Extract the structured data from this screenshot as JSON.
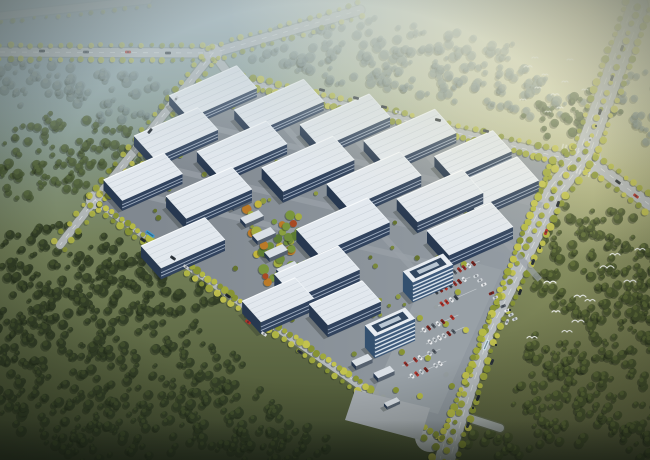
{
  "meta": {
    "kind": "aerial-architectural-rendering",
    "subject": "industrial-park",
    "width": 650,
    "height": 460
  },
  "palette": {
    "bgStops": [
      "#8fa5ad",
      "#94a795",
      "#7d8a63",
      "#6b7750",
      "#535d3b",
      "#3e472f"
    ],
    "warmGlow": "246,238,196",
    "coolGlow": "125,150,170",
    "hazeTop": "188,202,206",
    "rightWarmTint": "212,202,130",
    "vignette": "16,22,14",
    "asphalt": "#b3b8bb",
    "asphaltWide": "#b7bcbf",
    "casing": "#6e756f",
    "laneDash": "#eef2f2",
    "roadTree": [
      "#9fa83c",
      "#b4b944",
      "#879334",
      "#c2c24e"
    ],
    "treeStyles": [
      {
        "base": "#76898a",
        "hi": "#87998f",
        "op": 0.55
      },
      {
        "base": "#4c5c38",
        "hi": "#5d6f42",
        "op": 0.8
      },
      {
        "base": "#333f27",
        "hi": "#46542f",
        "op": 0.92
      },
      {
        "base": "#4a5730",
        "hi": "#66743c",
        "op": 0.9
      }
    ],
    "treeShadow": "#1f2819",
    "plot": [
      "#7e868e",
      "#959da4"
    ],
    "street": "#9aa1a8",
    "roofFactory": "#e2e8ee",
    "roofRidge": "#c9d1d9",
    "roofHi": "#f7fafc",
    "wallLong": "#31435e",
    "wallEnd": "#273850",
    "wallBand": "#b9c6d6",
    "towerWall": "#3e5a7b",
    "towerBand": "#dfe8ef",
    "towerRoof": "#e8edf2",
    "towerInset": "#31465f",
    "towerCore": "#b9c6d2",
    "shedRoof": "#d9dfe5",
    "shedWall": "#55606e",
    "shadow": "#1c2420",
    "parkPad": "#99a0a7",
    "plaza": "#a6acb1",
    "infillTree": [
      "#79883a",
      "#8d9a40",
      "#65742f"
    ],
    "gardenTree": [
      "#5d7c33",
      "#79953d",
      "#a3ad41",
      "#c3b63c",
      "#bb7a28",
      "#a84a24",
      "#6f8c3a",
      "#8aa03e"
    ],
    "parkCar": [
      "#b5342a",
      "#e8eaec",
      "#7c241e",
      "#cdd2d6",
      "#3a4148",
      "#e8eaec",
      "#99312a",
      "#596068"
    ],
    "bird": "#f4f6f4"
  },
  "forests": {
    "clusters": [
      [
        35,
        82,
        48,
        24,
        0
      ],
      [
        110,
        96,
        58,
        26,
        0
      ],
      [
        175,
        110,
        40,
        20,
        0
      ],
      [
        300,
        48,
        55,
        22,
        0
      ],
      [
        360,
        62,
        60,
        24,
        0
      ],
      [
        425,
        72,
        62,
        24,
        0
      ],
      [
        488,
        84,
        55,
        22,
        0
      ],
      [
        540,
        98,
        45,
        20,
        0
      ],
      [
        345,
        28,
        45,
        15,
        0
      ],
      [
        415,
        40,
        48,
        16,
        0
      ],
      [
        475,
        52,
        45,
        16,
        0
      ],
      [
        630,
        84,
        26,
        20,
        0
      ],
      [
        645,
        128,
        22,
        18,
        0
      ],
      [
        55,
        140,
        52,
        28,
        1
      ],
      [
        130,
        152,
        48,
        26,
        1
      ],
      [
        28,
        178,
        40,
        24,
        1
      ],
      [
        95,
        178,
        40,
        22,
        1
      ],
      [
        560,
        120,
        40,
        20,
        1
      ],
      [
        598,
        106,
        35,
        18,
        1
      ],
      [
        152,
        222,
        26,
        14,
        1
      ],
      [
        572,
        232,
        46,
        28,
        3
      ],
      [
        622,
        262,
        42,
        32,
        3
      ],
      [
        582,
        292,
        52,
        32,
        3
      ],
      [
        630,
        330,
        46,
        36,
        3
      ],
      [
        584,
        362,
        52,
        32,
        3
      ],
      [
        626,
        402,
        48,
        32,
        3
      ],
      [
        572,
        420,
        46,
        24,
        3
      ],
      [
        640,
        444,
        36,
        18,
        3
      ],
      [
        548,
        396,
        38,
        24,
        3
      ],
      [
        610,
        228,
        30,
        20,
        3
      ],
      [
        645,
        300,
        20,
        30,
        3
      ],
      [
        552,
        352,
        30,
        22,
        3
      ],
      [
        505,
        442,
        40,
        16,
        3
      ],
      [
        60,
        258,
        68,
        38,
        2
      ],
      [
        148,
        298,
        78,
        44,
        2
      ],
      [
        55,
        338,
        62,
        42,
        2
      ],
      [
        168,
        378,
        84,
        44,
        2
      ],
      [
        68,
        415,
        68,
        34,
        2
      ],
      [
        235,
        420,
        68,
        34,
        2
      ],
      [
        285,
        447,
        55,
        22,
        2
      ],
      [
        20,
        300,
        40,
        40,
        2
      ],
      [
        120,
        440,
        60,
        26,
        2
      ],
      [
        10,
        380,
        40,
        30,
        2
      ]
    ]
  },
  "roads": {
    "list": [
      {
        "id": "highway-top",
        "pts": [
          [
            0,
            16
          ],
          [
            148,
            0
          ]
        ],
        "w": 7,
        "op": 0.5,
        "trees": {
          "sides": [
            1
          ],
          "step": 11,
          "r": 2.0,
          "op": 0.55
        }
      },
      {
        "id": "road-topleft",
        "pts": [
          [
            0,
            52
          ],
          [
            213,
            53
          ],
          [
            360,
            10
          ]
        ],
        "w": 9,
        "op": 0.9,
        "dash": true,
        "trees": {
          "sides": [
            1,
            -1
          ],
          "step": 10,
          "r": 2.4,
          "op": 0.8
        }
      },
      {
        "id": "road-west",
        "pts": [
          [
            213,
            53
          ],
          [
            95,
            200
          ],
          [
            60,
            245
          ]
        ],
        "w": 8,
        "op": 0.95,
        "dash": true,
        "trees": {
          "sides": [
            1,
            -1
          ],
          "step": 10,
          "r": 2.6,
          "op": 0.85
        }
      },
      {
        "id": "road-connector",
        "pts": [
          [
            213,
            53
          ],
          [
            233,
            80
          ]
        ],
        "w": 8,
        "op": 0.95
      },
      {
        "id": "road-park-north",
        "pts": [
          [
            233,
            80
          ],
          [
            572,
            160
          ]
        ],
        "w": 9,
        "op": 1,
        "dash": true,
        "trees": {
          "sides": [
            1,
            -1
          ],
          "step": 9,
          "r": 2.8,
          "op": 0.95
        }
      },
      {
        "id": "road-park-west",
        "pts": [
          [
            95,
            200
          ],
          [
            428,
            432
          ]
        ],
        "w": 9,
        "op": 1,
        "dash": true,
        "trees": {
          "sides": [
            1,
            -1
          ],
          "step": 9,
          "r": 3.0,
          "op": 0.95
        }
      },
      {
        "id": "road-east-arm",
        "pts": [
          [
            592,
            162
          ],
          [
            650,
            205
          ]
        ],
        "w": 11,
        "op": 1,
        "dash": true,
        "trees": {
          "sides": [
            1,
            -1
          ],
          "step": 9,
          "r": 2.8,
          "op": 0.95
        }
      },
      {
        "id": "road-south-stub",
        "pts": [
          [
            428,
            405
          ],
          [
            500,
            428
          ]
        ],
        "w": 8,
        "op": 0.85
      },
      {
        "id": "boulevard-main",
        "pts": [
          [
            638,
            6
          ],
          [
            585,
            152
          ],
          [
            555,
            190
          ],
          [
            485,
            330
          ],
          [
            450,
            440
          ],
          [
            445,
            460
          ]
        ],
        "w": 20,
        "op": 1,
        "wide": true,
        "trees": {
          "sides": [
            1,
            -1
          ],
          "step": 8.5,
          "r": 3.0,
          "op": 0.95
        },
        "median": {
          "step": 9,
          "r": 2.6
        }
      }
    ],
    "pads": [
      [
        213,
        53,
        9
      ],
      [
        95,
        200,
        9
      ],
      [
        585,
        158,
        16
      ],
      [
        430,
        437,
        15
      ],
      [
        592,
        163,
        11
      ]
    ],
    "crosswalks": [
      [
        562,
        146,
        580,
        151
      ],
      [
        590,
        175,
        574,
        170
      ],
      [
        370,
        408,
        386,
        413
      ]
    ]
  },
  "vehicles": {
    "cars": [
      [
        42,
        51,
        1,
        "#2a3138"
      ],
      [
        86,
        52,
        1,
        "#3a424a"
      ],
      [
        128,
        52,
        1,
        "#b03028"
      ],
      [
        168,
        53,
        1,
        "#2a3138"
      ],
      [
        150,
        131,
        -51,
        "#2a3138"
      ],
      [
        176,
        99,
        -51,
        "#c8ccd0"
      ],
      [
        143,
        240,
        35,
        "#23292f"
      ],
      [
        173,
        258,
        35,
        "#2e353c"
      ],
      [
        186,
        267,
        35,
        "#c8ccd0"
      ],
      [
        228,
        296,
        35,
        "#23292f"
      ],
      [
        248,
        322,
        35,
        "#b03028"
      ],
      [
        264,
        334,
        35,
        "#d8dadc"
      ],
      [
        300,
        352,
        35,
        "#2e353c"
      ],
      [
        322,
        90,
        13,
        "#23292f"
      ],
      [
        356,
        98,
        13,
        "#2e353c"
      ],
      [
        384,
        107,
        13,
        "#23292f"
      ],
      [
        398,
        112,
        13,
        "#c8ccd0"
      ],
      [
        438,
        120,
        13,
        "#23292f"
      ],
      [
        486,
        131,
        13,
        "#2e353c"
      ],
      [
        622,
        48,
        110,
        "#23292f"
      ],
      [
        612,
        78,
        110,
        "#2e353c"
      ],
      [
        600,
        112,
        110,
        "#23292f"
      ],
      [
        590,
        140,
        110,
        "#c8ccd0"
      ],
      [
        558,
        204,
        110,
        "#23292f"
      ],
      [
        546,
        232,
        110,
        "#b03028"
      ],
      [
        533,
        262,
        110,
        "#2e353c"
      ],
      [
        520,
        292,
        110,
        "#23292f"
      ],
      [
        507,
        322,
        113,
        "#c8ccd0"
      ],
      [
        492,
        362,
        113,
        "#2e353c"
      ],
      [
        478,
        398,
        113,
        "#23292f"
      ],
      [
        468,
        425,
        113,
        "#2e353c"
      ],
      [
        618,
        182,
        37,
        "#23292f"
      ],
      [
        636,
        196,
        37,
        "#b03028"
      ]
    ],
    "buses": [
      [
        150,
        234,
        35,
        "#3f9ad0",
        10
      ],
      [
        486,
        345,
        113,
        "#cfe2ea",
        11
      ]
    ],
    "bikes": [
      [
        510,
        310
      ],
      [
        496,
        345
      ],
      [
        473,
        408
      ],
      [
        596,
        126
      ],
      [
        540,
        248
      ]
    ]
  },
  "park": {
    "plot": [
      [
        238,
        84
      ],
      [
        552,
        160
      ],
      [
        442,
        438
      ],
      [
        100,
        204
      ]
    ],
    "perimeter": {
      "step": 6.5,
      "rMin": 2.2,
      "rMax": 4.2
    },
    "streetsU": [
      [
        192,
        123,
        360
      ],
      [
        145,
        163,
        360
      ],
      [
        120,
        190,
        350
      ]
    ],
    "streetsV": [
      [
        252,
        90,
        268
      ],
      [
        324,
        104,
        240
      ],
      [
        396,
        120,
        215
      ]
    ],
    "infill": {
      "count": 80,
      "rMin": 1.6,
      "rMax": 3.0
    },
    "garden": {
      "poly": [
        [
          244,
          198
        ],
        [
          298,
          212
        ],
        [
          322,
          316
        ],
        [
          262,
          300
        ]
      ],
      "count": 60,
      "rMin": 2.4,
      "rMax": 5.4
    },
    "accents": [
      [
        512,
        185
      ],
      [
        517,
        191
      ],
      [
        509,
        193
      ],
      [
        362,
        308
      ],
      [
        300,
        240
      ]
    ],
    "factories": [
      [
        213,
        92,
        74,
        30,
        9
      ],
      [
        279,
        106,
        76,
        30,
        9
      ],
      [
        345,
        121,
        76,
        31,
        10
      ],
      [
        410,
        137,
        78,
        32,
        10
      ],
      [
        473,
        154,
        64,
        28,
        10
      ],
      [
        176,
        133,
        70,
        30,
        10
      ],
      [
        242,
        148,
        76,
        31,
        10
      ],
      [
        308,
        164,
        78,
        32,
        11
      ],
      [
        374,
        180,
        80,
        32,
        11
      ],
      [
        440,
        196,
        72,
        31,
        11
      ],
      [
        143,
        177,
        66,
        28,
        10
      ],
      [
        209,
        193,
        72,
        30,
        11
      ],
      [
        343,
        226,
        78,
        33,
        12
      ],
      [
        496,
        183,
        70,
        32,
        11
      ],
      [
        470,
        229,
        70,
        33,
        12
      ],
      [
        183,
        243,
        70,
        30,
        11
      ],
      [
        317,
        272,
        70,
        32,
        12
      ],
      [
        278,
        300,
        58,
        28,
        12
      ],
      [
        345,
        303,
        58,
        28,
        12
      ]
    ],
    "sheds": [
      [
        240,
        200,
        20,
        8,
        4
      ],
      [
        252,
        217,
        20,
        8,
        4
      ],
      [
        264,
        234,
        20,
        8,
        4
      ],
      [
        276,
        251,
        20,
        8,
        4
      ],
      [
        288,
        268,
        20,
        8,
        4
      ],
      [
        300,
        285,
        20,
        8,
        4
      ],
      [
        362,
        360,
        18,
        7,
        4
      ],
      [
        384,
        372,
        18,
        7,
        4
      ],
      [
        392,
        402,
        14,
        5,
        3
      ]
    ],
    "towers": [
      [
        428,
        268,
        44,
        15,
        20
      ],
      [
        390,
        322,
        44,
        15,
        22
      ]
    ],
    "parking": {
      "pad": [
        [
          436,
          252
        ],
        [
          502,
          270
        ],
        [
          438,
          414
        ],
        [
          372,
          396
        ]
      ],
      "rows": [
        [
          444,
          262,
          6
        ],
        [
          450,
          274,
          6
        ],
        [
          436,
          292,
          7
        ],
        [
          442,
          304,
          7
        ],
        [
          424,
          330,
          7
        ],
        [
          430,
          342,
          7
        ],
        [
          406,
          364,
          7
        ],
        [
          412,
          376,
          7
        ]
      ],
      "column": {
        "start": [
          476,
          276
        ],
        "n": 11,
        "step": 5.8
      },
      "trees": [
        [
          438,
          258
        ],
        [
          464,
          264
        ],
        [
          432,
          286
        ],
        [
          458,
          292
        ],
        [
          420,
          318
        ],
        [
          446,
          324
        ],
        [
          402,
          352
        ],
        [
          428,
          358
        ],
        [
          396,
          390
        ],
        [
          420,
          396
        ],
        [
          452,
          386
        ],
        [
          466,
          330
        ]
      ]
    },
    "plaza": [
      [
        355,
        390
      ],
      [
        430,
        408
      ],
      [
        420,
        440
      ],
      [
        345,
        420
      ]
    ]
  },
  "birds": {
    "flockRight": [
      [
        607,
        268,
        7
      ],
      [
        630,
        282,
        6
      ],
      [
        580,
        297,
        6
      ],
      [
        590,
        301,
        5
      ],
      [
        550,
        283,
        6
      ],
      [
        578,
        322,
        6
      ],
      [
        567,
        332,
        5
      ],
      [
        532,
        338,
        5
      ],
      [
        615,
        255,
        5
      ],
      [
        640,
        250,
        5
      ],
      [
        556,
        312,
        4
      ]
    ],
    "flockTop": [
      [
        528,
        67,
        4
      ],
      [
        545,
        75,
        3
      ],
      [
        538,
        88,
        3
      ],
      [
        555,
        95,
        4
      ],
      [
        565,
        82,
        3
      ],
      [
        523,
        100,
        3
      ],
      [
        560,
        108,
        3
      ],
      [
        548,
        112,
        3
      ],
      [
        570,
        60,
        3
      ],
      [
        585,
        90,
        3
      ],
      [
        535,
        58,
        3
      ]
    ]
  }
}
